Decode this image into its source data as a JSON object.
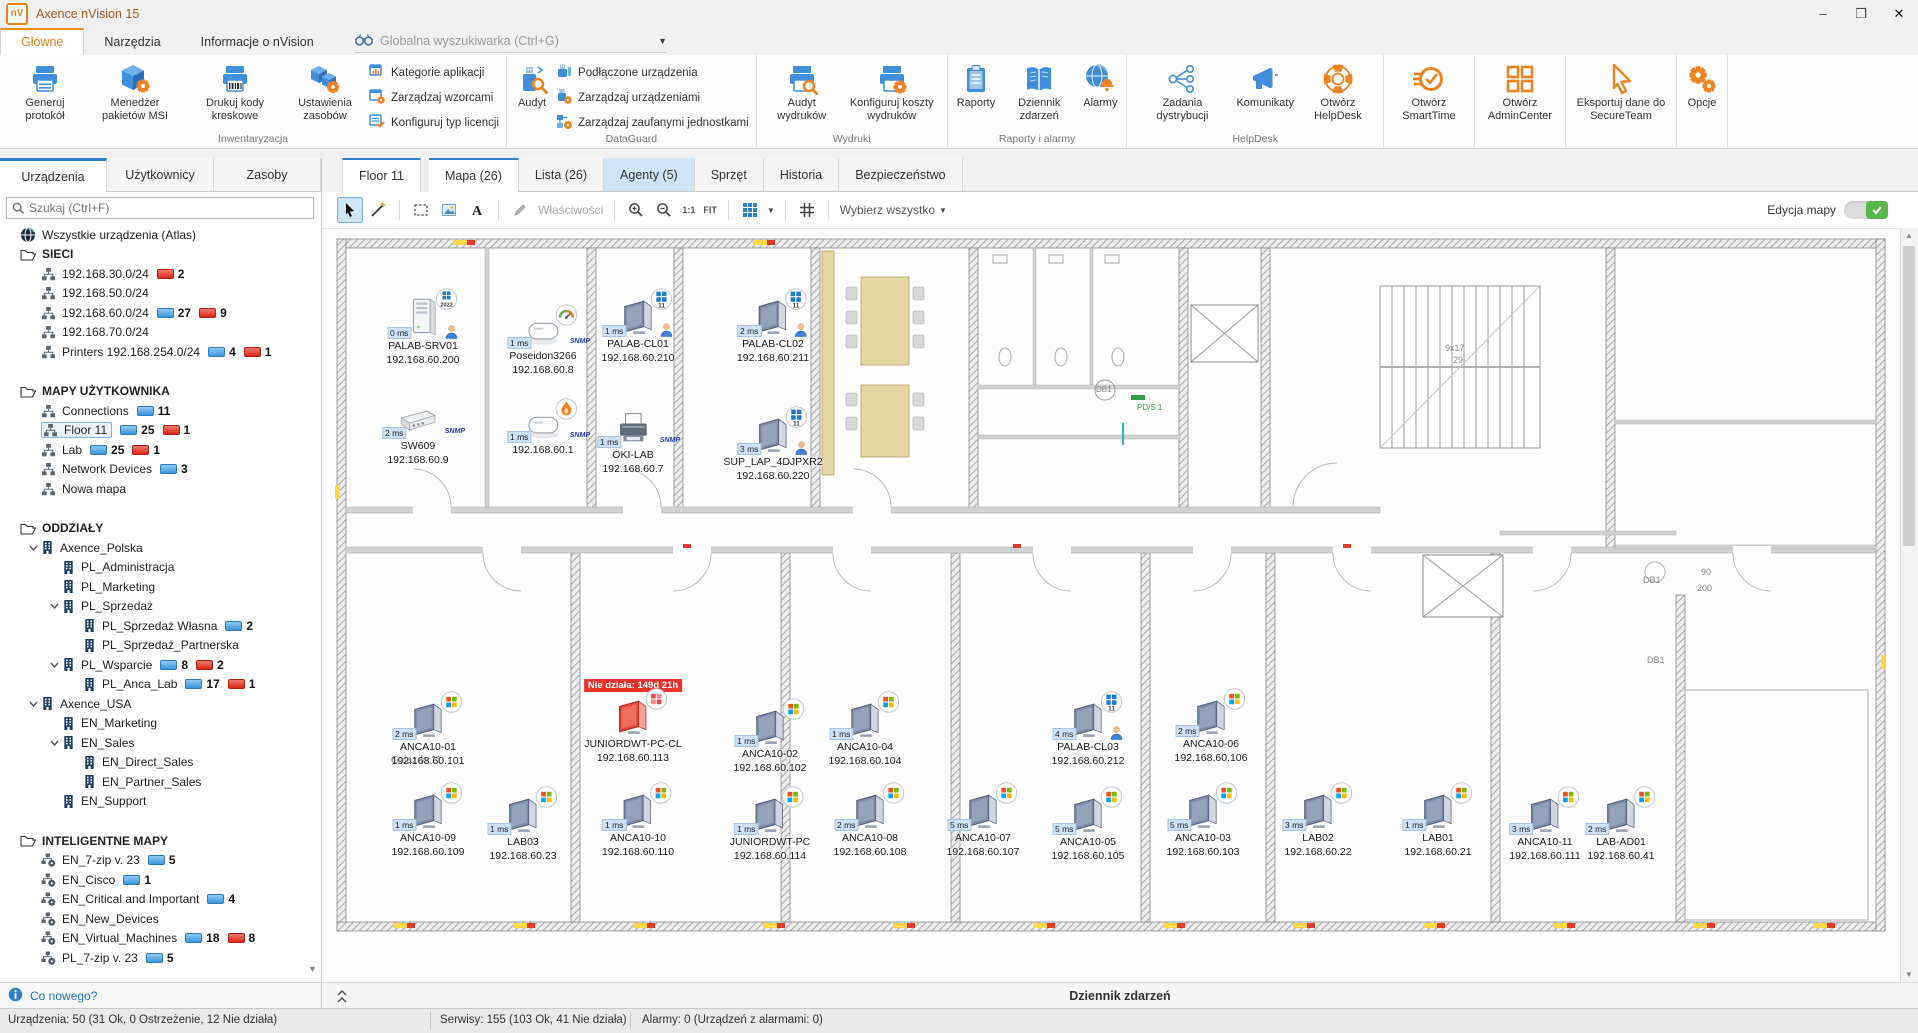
{
  "window": {
    "title": "Axence nVision 15",
    "logo": "nV",
    "controls": [
      "–",
      "❐",
      "✕"
    ]
  },
  "ribbon_tabs": [
    {
      "label": "Główne",
      "active": true
    },
    {
      "label": "Narzędzia",
      "active": false
    },
    {
      "label": "Informacje o nVision",
      "active": false
    }
  ],
  "global_search": {
    "label": "Globalna wyszukiwarka (Ctrl+G)"
  },
  "ribbon": {
    "groups": [
      {
        "label": "Inwentaryzacja",
        "big": [
          {
            "label": "Generuj protokół",
            "icon": "printer"
          },
          {
            "label": "Menedżer pakietów MSI",
            "icon": "cube-gear"
          },
          {
            "label": "Drukuj kody kreskowe",
            "icon": "printer-barcode"
          },
          {
            "label": "Ustawienia zasobów",
            "icon": "boxes-gear"
          }
        ],
        "small": [
          {
            "label": "Kategorie aplikacji",
            "icon": "win-chart"
          },
          {
            "label": "Zarządzaj wzorcami",
            "icon": "win-gear"
          },
          {
            "label": "Konfiguruj typ licencji",
            "icon": "win-check"
          }
        ]
      },
      {
        "label": "DataGuard",
        "big": [
          {
            "label": "Audyt",
            "icon": "usb-audit"
          }
        ],
        "small": [
          {
            "label": "Podłączone urządzenia",
            "icon": "usb-plain"
          },
          {
            "label": "Zarządzaj urządzeniami",
            "icon": "usb-gear"
          },
          {
            "label": "Zarządzaj zaufanymi jednostkami",
            "icon": "nodes-gear"
          }
        ]
      },
      {
        "label": "Wydruki",
        "big": [
          {
            "label": "Audyt wydruków",
            "icon": "printer-audit"
          },
          {
            "label": "Konfiguruj koszty wydruków",
            "icon": "printer-gear"
          }
        ]
      },
      {
        "label": "Raporty i alarmy",
        "big": [
          {
            "label": "Raporty",
            "icon": "clipboard"
          },
          {
            "label": "Dziennik zdarzeń",
            "icon": "book"
          },
          {
            "label": "Alarmy",
            "icon": "globe-bell"
          }
        ]
      },
      {
        "label": "HelpDesk",
        "big": [
          {
            "label": "Zadania dystrybucji",
            "icon": "share"
          },
          {
            "label": "Komunikaty",
            "icon": "megaphone"
          },
          {
            "label": "Otwórz HelpDesk",
            "icon": "lifebuoy"
          }
        ]
      },
      {
        "label": "",
        "big": [
          {
            "label": "Otwórz SmartTime",
            "icon": "smarttime"
          }
        ]
      },
      {
        "label": "",
        "big": [
          {
            "label": "Otwórz AdminCenter",
            "icon": "admincenter"
          }
        ]
      },
      {
        "label": "",
        "big": [
          {
            "label": "Eksportuj dane do SecureTeam",
            "icon": "cursor-orange"
          }
        ]
      },
      {
        "label": "",
        "big": [
          {
            "label": "Opcje",
            "icon": "gears"
          }
        ]
      }
    ]
  },
  "sidebar": {
    "tabs": [
      {
        "label": "Urządzenia",
        "active": true
      },
      {
        "label": "Użytkownicy",
        "active": false
      },
      {
        "label": "Zasoby",
        "active": false
      }
    ],
    "search_placeholder": "Szukaj (Ctrl+F)",
    "tree": [
      {
        "label": "Wszystkie urządzenia (Atlas)",
        "icon": "globe",
        "depth": 0
      },
      {
        "label": "SIECI",
        "icon": "folder",
        "depth": 0,
        "header": true
      },
      {
        "label": "192.168.30.0/24",
        "icon": "network",
        "depth": 1,
        "red": 2
      },
      {
        "label": "192.168.50.0/24",
        "icon": "network",
        "depth": 1
      },
      {
        "label": "192.168.60.0/24",
        "icon": "network",
        "depth": 1,
        "blue": 27,
        "red": 9
      },
      {
        "label": "192.168.70.0/24",
        "icon": "network",
        "depth": 1
      },
      {
        "label": "Printers 192.168.254.0/24",
        "icon": "network",
        "depth": 1,
        "blue": 4,
        "red": 1
      },
      {
        "gap": true
      },
      {
        "label": "MAPY UŻYTKOWNIKA",
        "icon": "folder",
        "depth": 0,
        "header": true
      },
      {
        "label": "Connections",
        "icon": "network",
        "depth": 1,
        "blue": 11
      },
      {
        "label": "Floor 11",
        "icon": "network",
        "depth": 1,
        "blue": 25,
        "red": 1,
        "selected": true
      },
      {
        "label": "Lab",
        "icon": "network",
        "depth": 1,
        "blue": 25,
        "red": 1
      },
      {
        "label": "Network Devices",
        "icon": "network",
        "depth": 1,
        "blue": 3
      },
      {
        "label": "Nowa mapa",
        "icon": "network",
        "depth": 1
      },
      {
        "gap": true
      },
      {
        "label": "ODDZIAŁY",
        "icon": "folder",
        "depth": 0,
        "header": true
      },
      {
        "label": "Axence_Polska",
        "icon": "building",
        "depth": 1,
        "expanded": true
      },
      {
        "label": "PL_Administracja",
        "icon": "building",
        "depth": 2
      },
      {
        "label": "PL_Marketing",
        "icon": "building",
        "depth": 2
      },
      {
        "label": "PL_Sprzedaż",
        "icon": "building",
        "depth": 2,
        "expanded": true
      },
      {
        "label": "PL_Sprzedaż Własna",
        "icon": "building",
        "depth": 3,
        "blue": 2
      },
      {
        "label": "PL_Sprzedaż_Partnerska",
        "icon": "building",
        "depth": 3
      },
      {
        "label": "PL_Wsparcie",
        "icon": "building",
        "depth": 2,
        "expanded": true,
        "blue": 8,
        "red": 2
      },
      {
        "label": "PL_Anca_Lab",
        "icon": "building",
        "depth": 3,
        "blue": 17,
        "red": 1
      },
      {
        "label": "Axence_USA",
        "icon": "building",
        "depth": 1,
        "expanded": true
      },
      {
        "label": "EN_Marketing",
        "icon": "building",
        "depth": 2
      },
      {
        "label": "EN_Sales",
        "icon": "building",
        "depth": 2,
        "expanded": true
      },
      {
        "label": "EN_Direct_Sales",
        "icon": "building",
        "depth": 3
      },
      {
        "label": "EN_Partner_Sales",
        "icon": "building",
        "depth": 3
      },
      {
        "label": "EN_Support",
        "icon": "building",
        "depth": 2
      },
      {
        "gap": true
      },
      {
        "label": "INTELIGENTNE MAPY",
        "icon": "folder",
        "depth": 0,
        "header": true
      },
      {
        "label": "EN_7-zip v. 23",
        "icon": "smartmap",
        "depth": 1,
        "blue": 5
      },
      {
        "label": "EN_Cisco",
        "icon": "smartmap",
        "depth": 1,
        "blue": 1
      },
      {
        "label": "EN_Critical and Important",
        "icon": "smartmap",
        "depth": 1,
        "blue": 4
      },
      {
        "label": "EN_New_Devices",
        "icon": "smartmap",
        "depth": 1
      },
      {
        "label": "EN_Virtual_Machines",
        "icon": "smartmap",
        "depth": 1,
        "blue": 18,
        "red": 8
      },
      {
        "label": "PL_7-zip v. 23",
        "icon": "smartmap",
        "depth": 1,
        "blue": 5
      }
    ],
    "whats_new": "Co nowego?"
  },
  "map": {
    "tabs": [
      {
        "label": "Floor 11",
        "active": true,
        "floor": true
      },
      {
        "label": "Mapa (26)",
        "active": true
      },
      {
        "label": "Lista (26)"
      },
      {
        "label": "Agenty (5)",
        "lightblue": true
      },
      {
        "label": "Sprzęt"
      },
      {
        "label": "Historia"
      },
      {
        "label": "Bezpieczeństwo"
      }
    ],
    "toolbar": [
      {
        "icon": "cursor",
        "active": true
      },
      {
        "icon": "line"
      },
      {
        "sep": true
      },
      {
        "icon": "marquee"
      },
      {
        "icon": "image"
      },
      {
        "icon": "text-a"
      },
      {
        "sep": true
      },
      {
        "icon": "pencil-gray",
        "label": "Właściwości",
        "disabled": true
      },
      {
        "sep": true
      },
      {
        "icon": "zoom-in"
      },
      {
        "icon": "zoom-out"
      },
      {
        "label": "1:1",
        "small": true
      },
      {
        "label": "FIT",
        "small": true
      },
      {
        "sep": true
      },
      {
        "icon": "grid-blue",
        "caret": true
      },
      {
        "sep": true
      },
      {
        "icon": "grid-dark"
      },
      {
        "sep": true
      },
      {
        "label": "Wybierz wszystko",
        "caret": true
      }
    ],
    "edit_label": "Edycja mapy",
    "snmp_label": "SNMP",
    "devices": [
      {
        "name": "PALAB-SRV01",
        "ip": "192.168.60.200",
        "ping": "0 ms",
        "x": 90,
        "y": 62,
        "type": "server",
        "badge": "2022",
        "person": true
      },
      {
        "name": "Poseidon3266",
        "ip": "192.168.60.8",
        "ping": "1 ms",
        "x": 210,
        "y": 78,
        "type": "box",
        "badge": "gauge",
        "snmp": true
      },
      {
        "name": "PALAB-CL01",
        "ip": "192.168.60.210",
        "ping": "1 ms",
        "x": 305,
        "y": 62,
        "type": "monitor",
        "badge": "11",
        "person": true
      },
      {
        "name": "PALAB-CL02",
        "ip": "192.168.60.211",
        "ping": "2 ms",
        "x": 440,
        "y": 62,
        "type": "monitor",
        "badge": "11",
        "person": true
      },
      {
        "name": "SW609",
        "ip": "192.168.60.9",
        "ping": "2 ms",
        "x": 85,
        "y": 168,
        "type": "switch",
        "snmp": true
      },
      {
        "name": "",
        "ip": "192.168.60.1",
        "ping": "1 ms",
        "x": 210,
        "y": 172,
        "type": "box",
        "badge": "fire",
        "snmp": true
      },
      {
        "name": "OKI-LAB",
        "ip": "192.168.60.7",
        "ping": "1 ms",
        "x": 300,
        "y": 175,
        "type": "printer",
        "snmp": true
      },
      {
        "name": "SUP_LAP_4DJPXR2",
        "ip": "192.168.60.220",
        "ping": "3 ms",
        "x": 440,
        "y": 180,
        "type": "monitor",
        "badge": "11",
        "person": true
      },
      {
        "name": "ANCA10-01",
        "ip": "192.168.60.101",
        "ping": "2 ms",
        "x": 95,
        "y": 465,
        "type": "monitor",
        "badge": "win"
      },
      {
        "name": "JUNIORDWT-PC-CL",
        "ip": "192.168.60.113",
        "ping": "",
        "x": 300,
        "y": 462,
        "type": "monitor",
        "badge": "win-red",
        "red": true,
        "alert": "Nie działa: 149d 21h"
      },
      {
        "name": "ANCA10-02",
        "ip": "192.168.60.102",
        "ping": "1 ms",
        "x": 437,
        "y": 472,
        "type": "monitor",
        "badge": "win"
      },
      {
        "name": "ANCA10-04",
        "ip": "192.168.60.104",
        "ping": "1 ms",
        "x": 532,
        "y": 465,
        "type": "monitor",
        "badge": "win"
      },
      {
        "name": "PALAB-CL03",
        "ip": "192.168.60.212",
        "ping": "4 ms",
        "x": 755,
        "y": 465,
        "type": "monitor",
        "badge": "11",
        "person": true
      },
      {
        "name": "ANCA10-06",
        "ip": "192.168.60.106",
        "ping": "2 ms",
        "x": 878,
        "y": 462,
        "type": "monitor",
        "badge": "win"
      },
      {
        "name": "ANCA10-09",
        "ip": "192.168.60.109",
        "ping": "1 ms",
        "x": 95,
        "y": 556,
        "type": "monitor",
        "badge": "win"
      },
      {
        "name": "LAB03",
        "ip": "192.168.60.23",
        "ping": "1 ms",
        "x": 190,
        "y": 560,
        "type": "monitor",
        "badge": "win"
      },
      {
        "name": "ANCA10-10",
        "ip": "192.168.60.110",
        "ping": "1 ms",
        "x": 305,
        "y": 556,
        "type": "monitor",
        "badge": "win"
      },
      {
        "name": "JUNIORDWT-PC",
        "ip": "192.168.60.114",
        "ping": "1 ms",
        "x": 437,
        "y": 560,
        "type": "monitor",
        "badge": "win"
      },
      {
        "name": "ANCA10-08",
        "ip": "192.168.60.108",
        "ping": "2 ms",
        "x": 537,
        "y": 556,
        "type": "monitor",
        "badge": "win"
      },
      {
        "name": "ANCA10-07",
        "ip": "192.168.60.107",
        "ping": "5 ms",
        "x": 650,
        "y": 556,
        "type": "monitor",
        "badge": "win"
      },
      {
        "name": "ANCA10-05",
        "ip": "192.168.60.105",
        "ping": "5 ms",
        "x": 755,
        "y": 560,
        "type": "monitor",
        "badge": "win"
      },
      {
        "name": "ANCA10-03",
        "ip": "192.168.60.103",
        "ping": "5 ms",
        "x": 870,
        "y": 556,
        "type": "monitor",
        "badge": "win"
      },
      {
        "name": "LAB02",
        "ip": "192.168.60.22",
        "ping": "3 ms",
        "x": 985,
        "y": 556,
        "type": "monitor",
        "badge": "win"
      },
      {
        "name": "LAB01",
        "ip": "192.168.60.21",
        "ping": "1 ms",
        "x": 1105,
        "y": 556,
        "type": "monitor",
        "badge": "win"
      },
      {
        "name": "ANCA10-11",
        "ip": "192.168.60.111",
        "ping": "3 ms",
        "x": 1212,
        "y": 560,
        "type": "monitor",
        "badge": "win"
      },
      {
        "name": "LAB-AD01",
        "ip": "192.168.60.41",
        "ping": "2 ms",
        "x": 1288,
        "y": 560,
        "type": "monitor",
        "badge": "win"
      }
    ],
    "annotations": [
      {
        "text": "Gniazdo 11",
        "x": 58,
        "y": 520,
        "color": "#333",
        "size": 10
      },
      {
        "text": "9x17",
        "x": 1112,
        "y": 108,
        "color": "#888",
        "size": 9
      },
      {
        "text": "29",
        "x": 1120,
        "y": 120,
        "color": "#888",
        "size": 9
      },
      {
        "text": "DB1",
        "x": 763,
        "y": 150,
        "color": "#888",
        "size": 8
      },
      {
        "text": "DB1",
        "x": 1310,
        "y": 340,
        "color": "#888",
        "size": 9
      },
      {
        "text": "90",
        "x": 1368,
        "y": 332,
        "color": "#888",
        "size": 9
      },
      {
        "text": "200",
        "x": 1364,
        "y": 348,
        "color": "#888",
        "size": 9
      },
      {
        "text": "DB1",
        "x": 1314,
        "y": 420,
        "color": "#888",
        "size": 9
      },
      {
        "text": "PD/S 1",
        "x": 804,
        "y": 168,
        "color": "#2e9e4f",
        "size": 8
      }
    ]
  },
  "eventlog_label": "Dziennik zdarzeń",
  "statusbar": [
    {
      "text": "Urządzenia: 50 (31 Ok, 0 Ostrzeżenie, 12 Nie działa)",
      "x": 8
    },
    {
      "text": "Serwisy: 155 (103 Ok, 41 Nie działa)",
      "x": 440
    },
    {
      "text": "Alarmy: 0 (Urządzeń z alarmami: 0)",
      "x": 642
    }
  ],
  "colors": {
    "accent_blue": "#2f80c8",
    "accent_orange": "#e8821e",
    "alarm_red": "#e8322a",
    "ok_blue": "#3d96dd",
    "down_red": "#db2618",
    "toggle_green": "#54b948"
  }
}
